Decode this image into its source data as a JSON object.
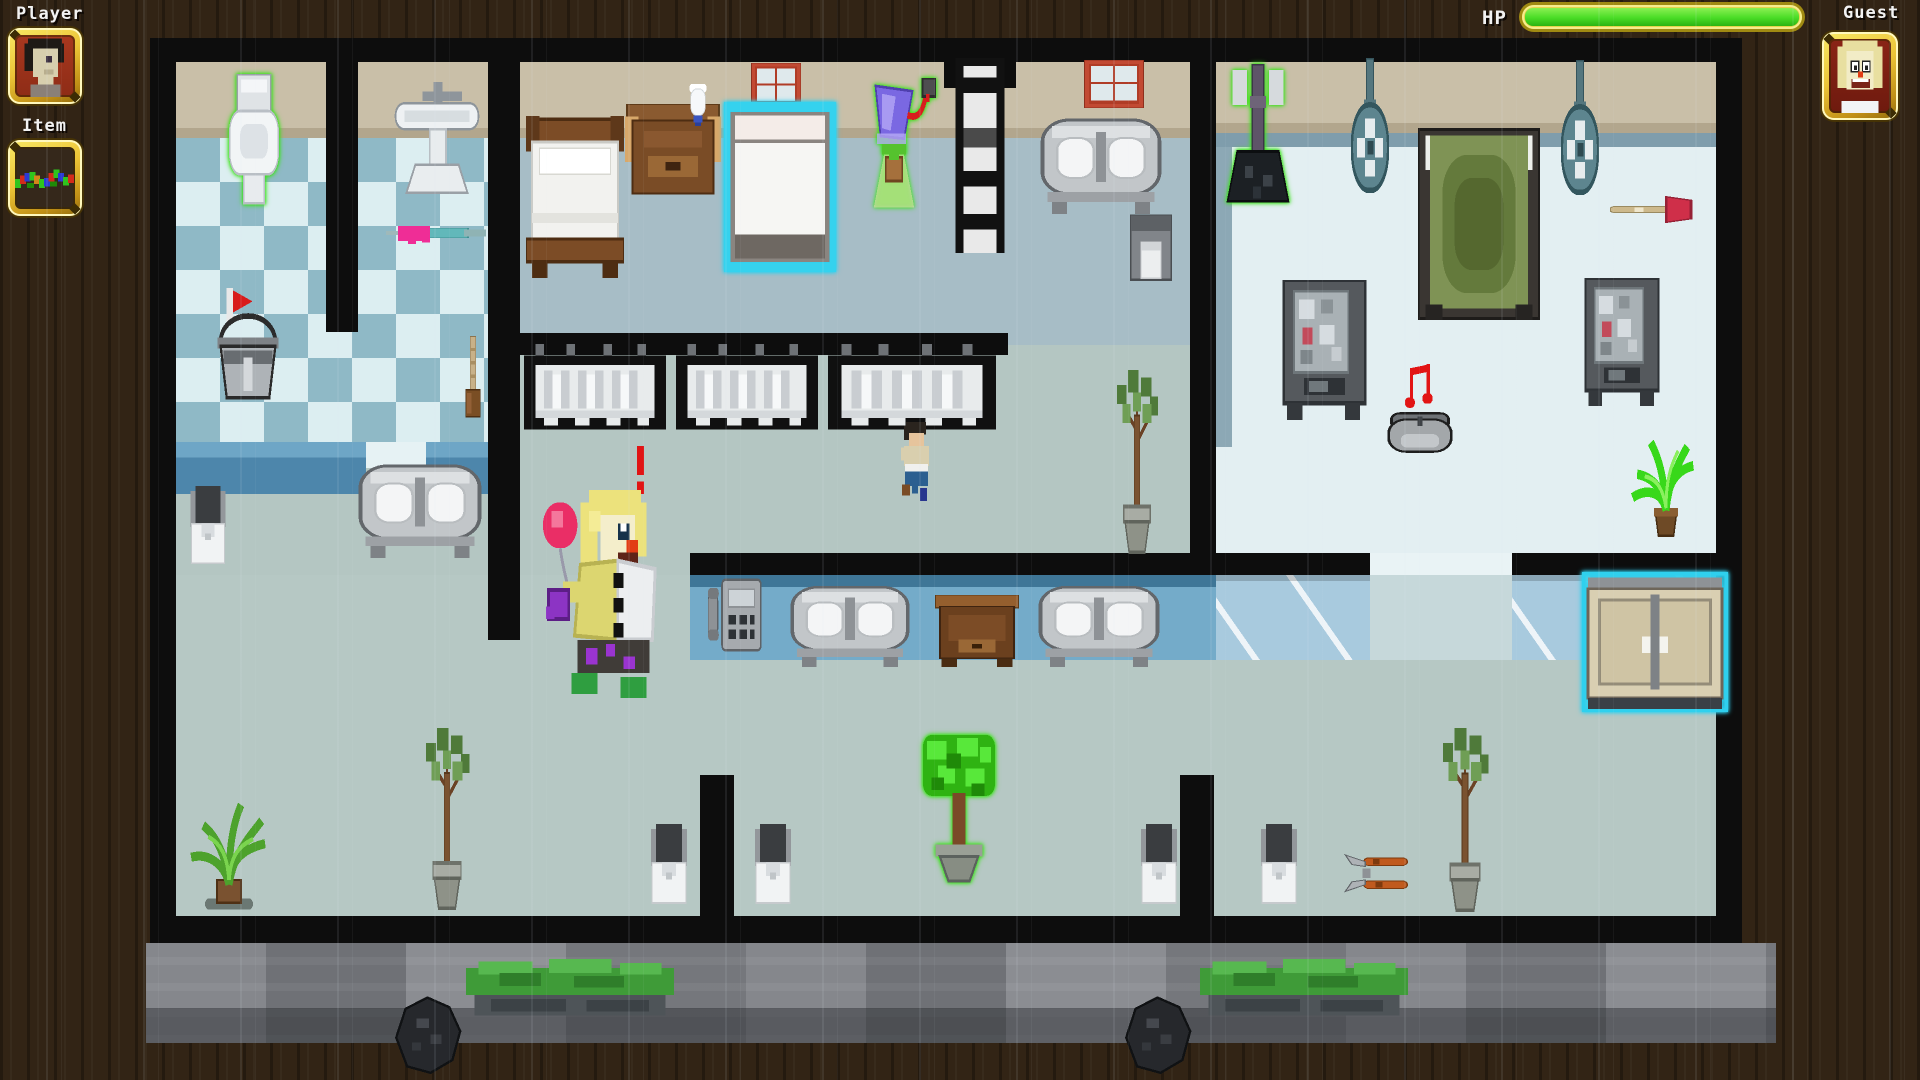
{
  "hud": {
    "player_label": "Player",
    "item_label": "Item",
    "hp_label": "HP",
    "guest_label": "Guest",
    "hp_percent": 100
  },
  "palette": {
    "gold_frame": "#e8c232",
    "hp_green": "#49dc26",
    "glow_green": "#3ae418",
    "highlight_cyan": "#2fd0ee",
    "wall_black": "#0d0d0d",
    "wood_background": "#322415",
    "floor_hallway": "#b4c6c2",
    "floor_bedroom": "#a7bdc6",
    "floor_bright_room": "#e3eff2",
    "tile_light": "#dceef1",
    "tile_dark": "#8fb9c6",
    "wall_tan": "#c9bfa8",
    "counter_blue": "#74abc9",
    "rubble_gray": "#7e8084"
  },
  "world": {
    "entities": [
      {
        "type": "toilet",
        "name": "glowing-toilet",
        "x": 222,
        "y": 74,
        "w": 64,
        "h": 132,
        "glow": "green",
        "interactable": true
      },
      {
        "type": "sink",
        "name": "pedestal-sink",
        "x": 392,
        "y": 82,
        "w": 90,
        "h": 118,
        "glow": null,
        "interactable": true
      },
      {
        "type": "window",
        "name": "window-1",
        "x": 751,
        "y": 63,
        "w": 50,
        "h": 45,
        "glow": null,
        "interactable": false
      },
      {
        "type": "window",
        "name": "window-2",
        "x": 1084,
        "y": 60,
        "w": 60,
        "h": 48,
        "glow": null,
        "interactable": false
      },
      {
        "type": "ladder",
        "name": "ladder",
        "x": 948,
        "y": 58,
        "w": 64,
        "h": 195,
        "glow": null,
        "interactable": true
      },
      {
        "type": "mop-green",
        "name": "glowing-mop",
        "x": 1218,
        "y": 64,
        "w": 80,
        "h": 146,
        "glow": "green",
        "interactable": true
      },
      {
        "type": "fan",
        "name": "ceiling-fan-1",
        "x": 1340,
        "y": 58,
        "w": 60,
        "h": 138,
        "glow": null,
        "interactable": true
      },
      {
        "type": "fan",
        "name": "ceiling-fan-2",
        "x": 1550,
        "y": 60,
        "w": 60,
        "h": 138,
        "glow": null,
        "interactable": true
      },
      {
        "type": "bed-green",
        "name": "green-bed",
        "x": 1418,
        "y": 128,
        "w": 122,
        "h": 192,
        "glow": null,
        "interactable": true
      },
      {
        "type": "bed-wood",
        "name": "wooden-bed",
        "x": 526,
        "y": 116,
        "w": 98,
        "h": 162,
        "glow": null,
        "interactable": true
      },
      {
        "type": "nightstand",
        "name": "nightstand",
        "x": 625,
        "y": 104,
        "w": 96,
        "h": 104,
        "glow": null,
        "interactable": true
      },
      {
        "type": "vase",
        "name": "vase",
        "x": 680,
        "y": 84,
        "w": 36,
        "h": 48,
        "glow": null,
        "interactable": false
      },
      {
        "type": "bed-cyan",
        "name": "highlighted-bed",
        "x": 724,
        "y": 102,
        "w": 112,
        "h": 170,
        "glow": "cyan",
        "interactable": true
      },
      {
        "type": "lamp-plant",
        "name": "plant-lamp",
        "x": 852,
        "y": 78,
        "w": 84,
        "h": 132,
        "glow": "green",
        "interactable": true
      },
      {
        "type": "bench-metal",
        "name": "metal-bed",
        "x": 1040,
        "y": 114,
        "w": 122,
        "h": 100,
        "glow": null,
        "interactable": true
      },
      {
        "type": "trash-bin",
        "name": "trash-bin",
        "x": 1128,
        "y": 214,
        "w": 46,
        "h": 70,
        "glow": null,
        "interactable": true
      },
      {
        "type": "plunger",
        "name": "plunger-item",
        "x": 1610,
        "y": 188,
        "w": 88,
        "h": 44,
        "glow": null,
        "interactable": true
      },
      {
        "type": "syringe",
        "name": "syringe-item",
        "x": 386,
        "y": 216,
        "w": 100,
        "h": 34,
        "glow": null,
        "interactable": true
      },
      {
        "type": "vending",
        "name": "vending-machine-1",
        "x": 1282,
        "y": 280,
        "w": 85,
        "h": 140,
        "glow": null,
        "interactable": true
      },
      {
        "type": "vending",
        "name": "vending-machine-2",
        "x": 1584,
        "y": 278,
        "w": 76,
        "h": 128,
        "glow": null,
        "interactable": true
      },
      {
        "type": "bucket",
        "name": "mop-bucket",
        "x": 210,
        "y": 288,
        "w": 76,
        "h": 112,
        "glow": null,
        "interactable": true
      },
      {
        "type": "broom",
        "name": "broom",
        "x": 455,
        "y": 336,
        "w": 36,
        "h": 84,
        "glow": null,
        "interactable": true
      },
      {
        "type": "shower-stall",
        "name": "shower-stall-1",
        "x": 524,
        "y": 344,
        "w": 142,
        "h": 95,
        "glow": null,
        "interactable": true
      },
      {
        "type": "shower-stall",
        "name": "shower-stall-2",
        "x": 676,
        "y": 344,
        "w": 142,
        "h": 95,
        "glow": null,
        "interactable": true
      },
      {
        "type": "shower-stall",
        "name": "shower-stall-3",
        "x": 828,
        "y": 344,
        "w": 168,
        "h": 95,
        "glow": null,
        "interactable": true
      },
      {
        "type": "note",
        "name": "music-note",
        "x": 1404,
        "y": 360,
        "w": 42,
        "h": 52,
        "glow": null,
        "interactable": false
      },
      {
        "type": "tree-pot",
        "name": "potted-tree-center",
        "x": 1104,
        "y": 366,
        "w": 66,
        "h": 190,
        "glow": null,
        "interactable": true
      },
      {
        "type": "music-pot",
        "name": "music-player",
        "x": 1386,
        "y": 406,
        "w": 68,
        "h": 52,
        "glow": null,
        "interactable": true
      },
      {
        "type": "boy",
        "name": "npc-runner",
        "x": 892,
        "y": 420,
        "w": 50,
        "h": 92,
        "glow": null,
        "interactable": true
      },
      {
        "type": "plant-bright",
        "name": "potted-plant-bright",
        "x": 1628,
        "y": 434,
        "w": 76,
        "h": 106,
        "glow": null,
        "interactable": true
      },
      {
        "type": "exclamation",
        "name": "alert-exclamation",
        "x": 629,
        "y": 446,
        "w": 23,
        "h": 48,
        "glow": null,
        "interactable": false
      },
      {
        "type": "bench-metal",
        "name": "metal-bench-left",
        "x": 358,
        "y": 460,
        "w": 124,
        "h": 98,
        "glow": null,
        "interactable": true
      },
      {
        "type": "toilet-small",
        "name": "toilet-lower-left",
        "x": 184,
        "y": 486,
        "w": 48,
        "h": 82,
        "glow": null,
        "interactable": true
      },
      {
        "type": "clown",
        "name": "guest-clown",
        "x": 540,
        "y": 490,
        "w": 144,
        "h": 208,
        "glow": null,
        "interactable": true
      },
      {
        "type": "phone",
        "name": "payphone",
        "x": 708,
        "y": 575,
        "w": 54,
        "h": 80,
        "glow": null,
        "interactable": true
      },
      {
        "type": "bench-metal",
        "name": "metal-bench-1",
        "x": 790,
        "y": 582,
        "w": 120,
        "h": 85,
        "glow": null,
        "interactable": true
      },
      {
        "type": "table-wood",
        "name": "wooden-table",
        "x": 935,
        "y": 595,
        "w": 84,
        "h": 72,
        "glow": null,
        "interactable": true
      },
      {
        "type": "bench-metal",
        "name": "metal-bench-2",
        "x": 1038,
        "y": 582,
        "w": 122,
        "h": 85,
        "glow": null,
        "interactable": true
      },
      {
        "type": "cabinet",
        "name": "highlighted-cabinet",
        "x": 1582,
        "y": 572,
        "w": 146,
        "h": 140,
        "glow": "cyan",
        "interactable": true
      },
      {
        "type": "tree-pot",
        "name": "potted-tree-left",
        "x": 412,
        "y": 724,
        "w": 70,
        "h": 188,
        "glow": null,
        "interactable": true
      },
      {
        "type": "tree-pot",
        "name": "potted-tree-right",
        "x": 1428,
        "y": 724,
        "w": 74,
        "h": 190,
        "glow": null,
        "interactable": true
      },
      {
        "type": "glow-tree",
        "name": "glowing-topiary",
        "x": 906,
        "y": 732,
        "w": 106,
        "h": 152,
        "glow": "green",
        "interactable": true
      },
      {
        "type": "plant-leafy",
        "name": "leafy-plant",
        "x": 186,
        "y": 798,
        "w": 86,
        "h": 114,
        "glow": null,
        "interactable": true
      },
      {
        "type": "toilet-small",
        "name": "toilet-bottom-1",
        "x": 644,
        "y": 824,
        "w": 50,
        "h": 84,
        "glow": null,
        "interactable": true
      },
      {
        "type": "toilet-small",
        "name": "toilet-bottom-2",
        "x": 748,
        "y": 824,
        "w": 50,
        "h": 84,
        "glow": null,
        "interactable": true
      },
      {
        "type": "toilet-small",
        "name": "toilet-bottom-3",
        "x": 1134,
        "y": 824,
        "w": 50,
        "h": 84,
        "glow": null,
        "interactable": true
      },
      {
        "type": "toilet-small",
        "name": "toilet-bottom-4",
        "x": 1254,
        "y": 824,
        "w": 50,
        "h": 84,
        "glow": null,
        "interactable": true
      },
      {
        "type": "pliers",
        "name": "pliers-item",
        "x": 1344,
        "y": 854,
        "w": 66,
        "h": 48,
        "glow": null,
        "interactable": true
      },
      {
        "type": "bush",
        "name": "hedge-1",
        "x": 466,
        "y": 954,
        "w": 208,
        "h": 64,
        "glow": null,
        "interactable": false
      },
      {
        "type": "bush",
        "name": "hedge-2",
        "x": 1200,
        "y": 954,
        "w": 208,
        "h": 64,
        "glow": null,
        "interactable": false
      },
      {
        "type": "rock",
        "name": "trash-bag-1",
        "x": 390,
        "y": 996,
        "w": 78,
        "h": 80,
        "glow": null,
        "interactable": false
      },
      {
        "type": "rock",
        "name": "trash-bag-2",
        "x": 1120,
        "y": 996,
        "w": 78,
        "h": 80,
        "glow": null,
        "interactable": false
      }
    ]
  }
}
